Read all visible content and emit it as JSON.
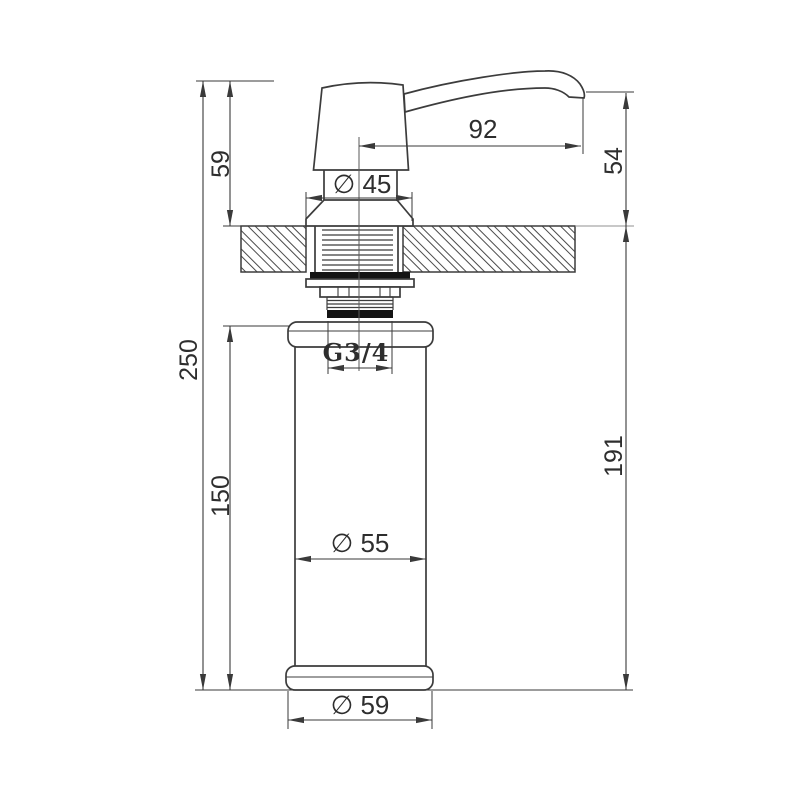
{
  "drawing": {
    "type": "technical-dimension-drawing",
    "subject": "counter-mounted soap dispenser, side elevation",
    "colors": {
      "line": "#3c3c3c",
      "dimension": "#3a3a3a",
      "seal": "#141414",
      "background": "#ffffff"
    },
    "labels": {
      "overall_height": "250",
      "pump_above_counter": "59",
      "bottle_section_height": "150",
      "spout_reach": "92",
      "spout_above_counter": "54",
      "below_counter_height": "191",
      "collar_diameter": "∅ 45",
      "thread_size": "G3/4",
      "body_diameter": "∅ 55",
      "base_diameter": "∅ 59"
    }
  }
}
